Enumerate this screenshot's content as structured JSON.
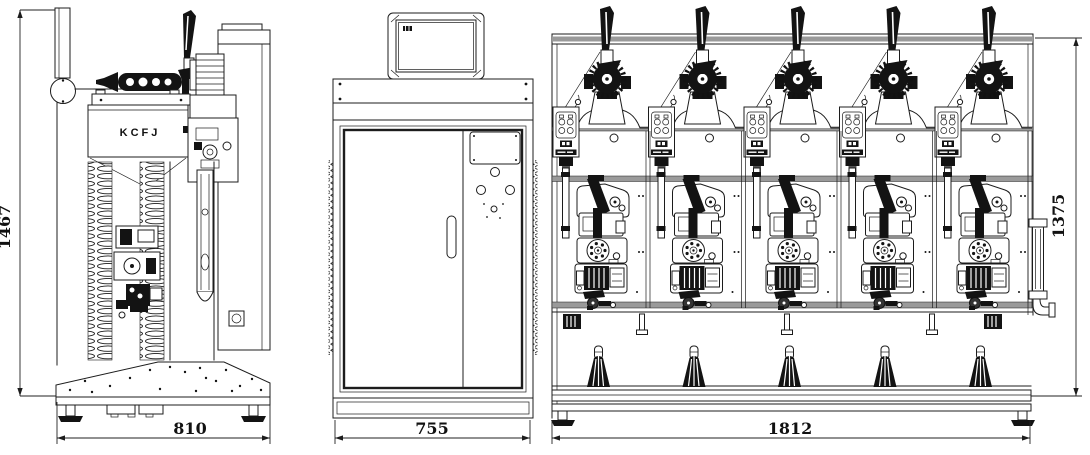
{
  "drawing": {
    "machine_label": "KCFJ",
    "line_color": "#1c1c1c",
    "paper_color": "#ffffff",
    "views": {
      "side": {
        "height_dim": "1467",
        "width_dim": "810"
      },
      "cabinet": {
        "width_dim": "755"
      },
      "front": {
        "width_dim": "1812",
        "height_dim": "1375",
        "spindle_count": 5,
        "bobbin_count": 5,
        "support_pegs": 3
      }
    }
  }
}
